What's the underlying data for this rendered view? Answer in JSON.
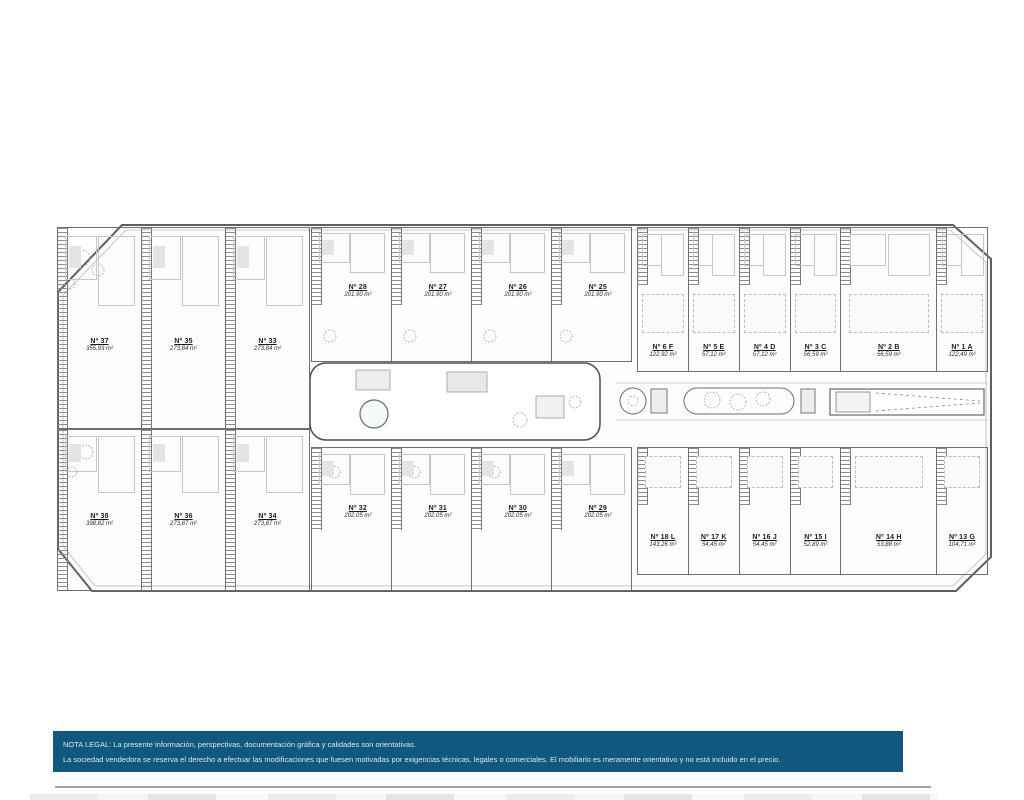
{
  "colors": {
    "legal_bar_bg": "#10587d",
    "legal_text": "#dde9ee",
    "plan_outline": "#5f5f5f"
  },
  "plan": {
    "left_top_units": [
      {
        "num": "Nº 37",
        "area": "355,93 m²"
      },
      {
        "num": "Nº 35",
        "area": "273,84 m²"
      },
      {
        "num": "Nº 33",
        "area": "273,84 m²"
      }
    ],
    "left_bottom_units": [
      {
        "num": "Nº 38",
        "area": "398,82 m²"
      },
      {
        "num": "Nº 36",
        "area": "273,87 m²"
      },
      {
        "num": "Nº 34",
        "area": "273,87 m²"
      }
    ],
    "mid_top_units": [
      {
        "num": "Nº 28",
        "area": "201,90 m²"
      },
      {
        "num": "Nº 27",
        "area": "201,90 m²"
      },
      {
        "num": "Nº 26",
        "area": "201,90 m²"
      },
      {
        "num": "Nº 25",
        "area": "201,90 m²"
      }
    ],
    "mid_bottom_units": [
      {
        "num": "Nº 32",
        "area": "202,05 m²"
      },
      {
        "num": "Nº 31",
        "area": "202,05 m²"
      },
      {
        "num": "Nº 30",
        "area": "202,05 m²"
      },
      {
        "num": "Nº 29",
        "area": "202,05 m²"
      }
    ],
    "right_top_units": [
      {
        "num": "Nº 6 F",
        "area": "122,92 m²"
      },
      {
        "num": "Nº 5 E",
        "area": "57,12 m²"
      },
      {
        "num": "Nº 4 D",
        "area": "57,12 m²"
      },
      {
        "num": "Nº 3 C",
        "area": "56,59 m²"
      },
      {
        "num": "Nº 2 B",
        "area": "56,59 m²"
      },
      {
        "num": "Nº 1 A",
        "area": "122,49 m²"
      }
    ],
    "right_bottom_units": [
      {
        "num": "Nº 18 L",
        "area": "143,26 m²"
      },
      {
        "num": "Nº 17 K",
        "area": "54,45 m²"
      },
      {
        "num": "Nº 16 J",
        "area": "54,45 m²"
      },
      {
        "num": "Nº 15 I",
        "area": "52,89 m²"
      },
      {
        "num": "Nº 14 H",
        "area": "53,88 m²"
      },
      {
        "num": "Nº 13 G",
        "area": "104,71 m²"
      }
    ]
  },
  "legal": {
    "line1": "NOTA LEGAL: La presente información, perspectivas, documentación gráfica y calidades son orientativas.",
    "line2": "La sociedad vendedora se reserva el derecho a efectuar las modificaciones que fuesen motivadas por exigencias técnicas, legales o comerciales. El mobiliario es meramente orientativo y no está incluido en el precio."
  }
}
